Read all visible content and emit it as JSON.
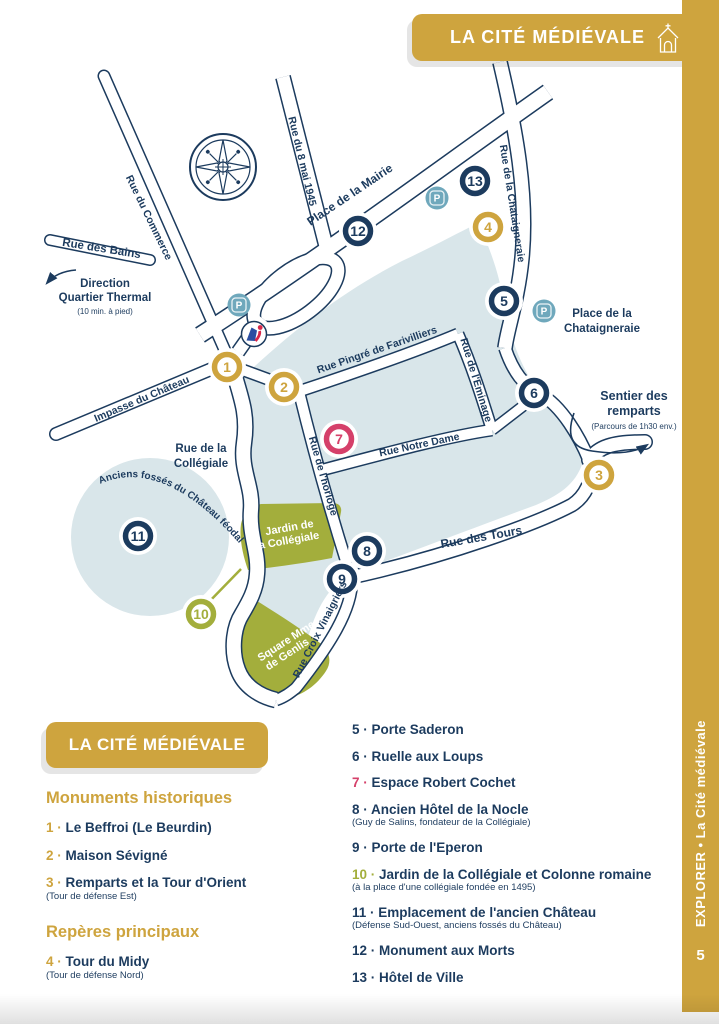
{
  "banner": {
    "title": "LA CITÉ MÉDIÉVALE",
    "icon": "church-icon"
  },
  "sidebar": {
    "label": "EXPLORER • La Cité médiévale",
    "page_number": "5"
  },
  "colors": {
    "gold": "#CEA43E",
    "navy": "#1C3B5E",
    "pink": "#D5406A",
    "olive": "#A3AE3C",
    "light_blue": "#D9E6EA",
    "teal": "#6FA8BC",
    "white": "#FFFFFF"
  },
  "map": {
    "streets": {
      "mai1945": "Rue du 8 mai 1945",
      "mairie": "Place de la Mairie",
      "chataigneraie": "Rue de la Chataigneraie",
      "commerce": "Rue du Commerce",
      "bains": "Rue des Bains",
      "impasse": "Impasse du Château",
      "pingre": "Rue Pingré de Farivilliers",
      "eminage": "Rue de l'Eminage",
      "horloge": "Rue de l'horloge",
      "notredame": "Rue Notre Dame",
      "tours": "Rue des Tours",
      "vinaigriers": "Rue Croix Vinaigriers"
    },
    "labels": {
      "direction_line1": "Direction",
      "direction_line2": "Quartier Thermal",
      "direction_note": "(10 min. à pied)",
      "place_chat_line1": "Place de la",
      "place_chat_line2": "Chataigneraie",
      "sentier_line1": "Sentier des",
      "sentier_line2": "remparts",
      "sentier_note": "(Parcours de 1h30 env.)",
      "collegiale_line1": "Rue de la",
      "collegiale_line2": "Collégiale",
      "fosses": "Anciens fossés du Château féodal",
      "jardin_line1": "Jardin de",
      "jardin_line2": "la Collégiale",
      "square_line1": "Square Mme",
      "square_line2": "de Genlis"
    },
    "parking_letter": "P",
    "parkings": [
      {
        "x": 239,
        "y": 305
      },
      {
        "x": 437,
        "y": 198
      },
      {
        "x": 544,
        "y": 311
      }
    ],
    "markers": [
      {
        "num": "1",
        "color": "gold",
        "x": 227,
        "y": 367
      },
      {
        "num": "2",
        "color": "gold",
        "x": 284,
        "y": 387
      },
      {
        "num": "3",
        "color": "gold",
        "x": 599,
        "y": 475
      },
      {
        "num": "4",
        "color": "gold",
        "x": 488,
        "y": 227
      },
      {
        "num": "5",
        "color": "navy",
        "x": 504,
        "y": 301
      },
      {
        "num": "6",
        "color": "navy",
        "x": 534,
        "y": 393
      },
      {
        "num": "7",
        "color": "pink",
        "x": 339,
        "y": 439
      },
      {
        "num": "8",
        "color": "navy",
        "x": 367,
        "y": 551
      },
      {
        "num": "9",
        "color": "navy",
        "x": 342,
        "y": 579
      },
      {
        "num": "10",
        "color": "olive",
        "x": 201,
        "y": 614
      },
      {
        "num": "11",
        "color": "navy",
        "x": 138,
        "y": 536
      },
      {
        "num": "12",
        "color": "navy",
        "x": 358,
        "y": 231
      },
      {
        "num": "13",
        "color": "navy",
        "x": 475,
        "y": 181
      }
    ]
  },
  "legend": {
    "title": "LA CITÉ MÉDIÉVALE",
    "sections": [
      {
        "heading": "Monuments historiques",
        "items": [
          {
            "num": "1",
            "color": "gold",
            "label": "Le Beffroi (Le Beurdin)"
          },
          {
            "num": "2",
            "color": "gold",
            "label": "Maison Sévigné"
          },
          {
            "num": "3",
            "color": "gold",
            "label": "Remparts et la Tour d'Orient",
            "sub": "(Tour de défense Est)"
          }
        ]
      },
      {
        "heading": "Repères principaux",
        "items": [
          {
            "num": "4",
            "color": "gold",
            "label": "Tour du Midy",
            "sub": "(Tour de défense Nord)"
          }
        ]
      }
    ],
    "right_items": [
      {
        "num": "5",
        "color": "navy",
        "label": "Porte Saderon"
      },
      {
        "num": "6",
        "color": "navy",
        "label": "Ruelle aux Loups"
      },
      {
        "num": "7",
        "color": "pink",
        "label": "Espace Robert Cochet"
      },
      {
        "num": "8",
        "color": "navy",
        "label": "Ancien Hôtel de la Nocle",
        "sub": "(Guy de Salins, fondateur de la Collégiale)"
      },
      {
        "num": "9",
        "color": "navy",
        "label": "Porte de l'Eperon"
      },
      {
        "num": "10",
        "color": "olive",
        "label": "Jardin de la Collégiale et Colonne romaine",
        "sub": "(à la place d'une collégiale fondée en 1495)"
      },
      {
        "num": "11",
        "color": "navy",
        "label": "Emplacement de l'ancien Château",
        "sub": "(Défense Sud-Ouest, anciens fossés du Château)"
      },
      {
        "num": "12",
        "color": "navy",
        "label": "Monument aux Morts"
      },
      {
        "num": "13",
        "color": "navy",
        "label": "Hôtel de Ville"
      }
    ]
  }
}
